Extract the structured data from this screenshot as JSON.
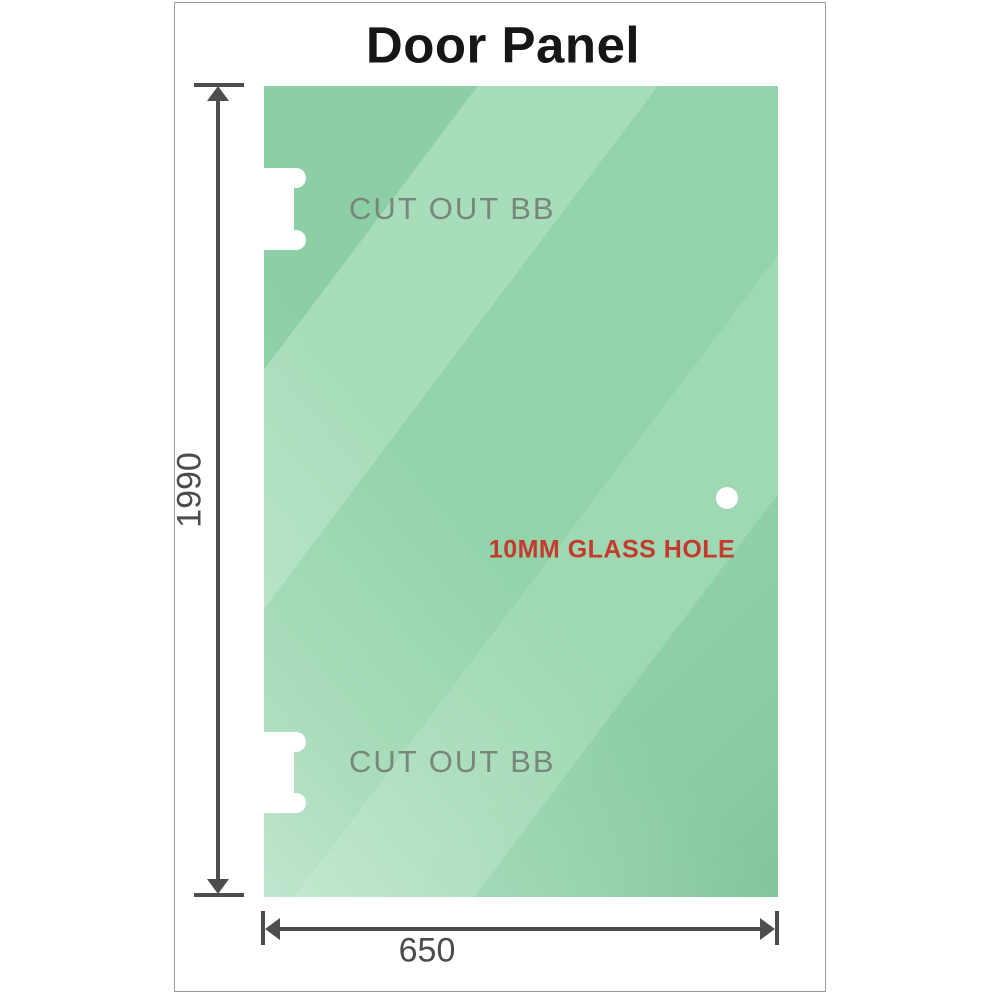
{
  "title": "Door Panel",
  "diagram": {
    "height_label": "1990",
    "width_label": "650",
    "cutout_top_label": "CUT OUT BB",
    "cutout_bottom_label": "CUT OUT BB",
    "hole_label": "10MM GLASS HOLE"
  },
  "colors": {
    "dimension_lines": "#4d4d4d",
    "dimension_text": "#4c4c4c",
    "cutout_label_text": "#7a857c",
    "hole_label_text": "#c43a2c",
    "glass_green_base": "#93d3ab",
    "glass_green_light": "#a7ddbb",
    "cutout_fill": "#ffffff",
    "frame_border": "#999999",
    "title_text": "#161616"
  }
}
